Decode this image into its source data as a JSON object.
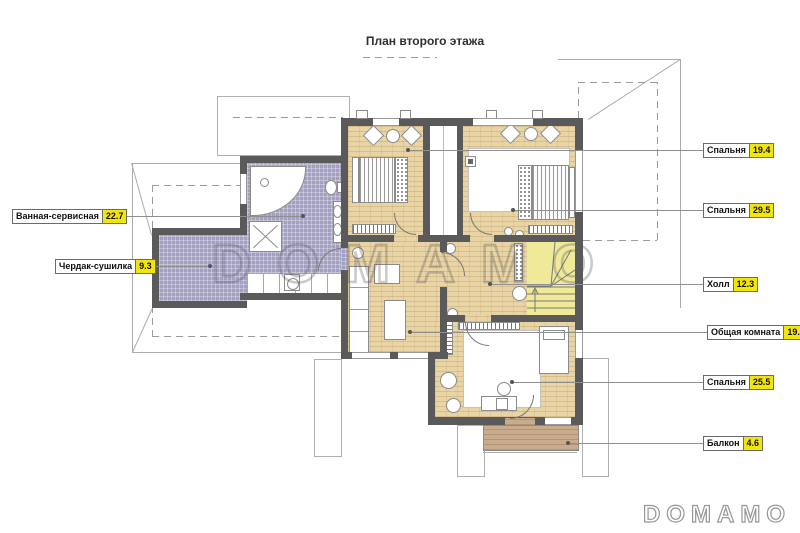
{
  "title": "План второго этажа",
  "watermarks": {
    "center": "DOMAMO",
    "corner": "DOMAMO"
  },
  "colors": {
    "wall": "#5a5a5a",
    "wood_floor": "#e9d4a5",
    "bath_tile": "#a3a1c2",
    "stairs": "#f0e999",
    "balcony": "#c9ac8e",
    "label_value_bg": "#f2e50a"
  },
  "labels": {
    "left": [
      {
        "name": "Ванная-сервисная",
        "value": "22.7"
      },
      {
        "name": "Чердак-сушилка",
        "value": "9.3"
      }
    ],
    "right": [
      {
        "name": "Спальня",
        "value": "19.4"
      },
      {
        "name": "Спальня",
        "value": "29.5"
      },
      {
        "name": "Холл",
        "value": "12.3"
      },
      {
        "name": "Общая комната",
        "value": "19.1"
      },
      {
        "name": "Спальня",
        "value": "25.5"
      },
      {
        "name": "Балкон",
        "value": "4.6"
      }
    ]
  }
}
